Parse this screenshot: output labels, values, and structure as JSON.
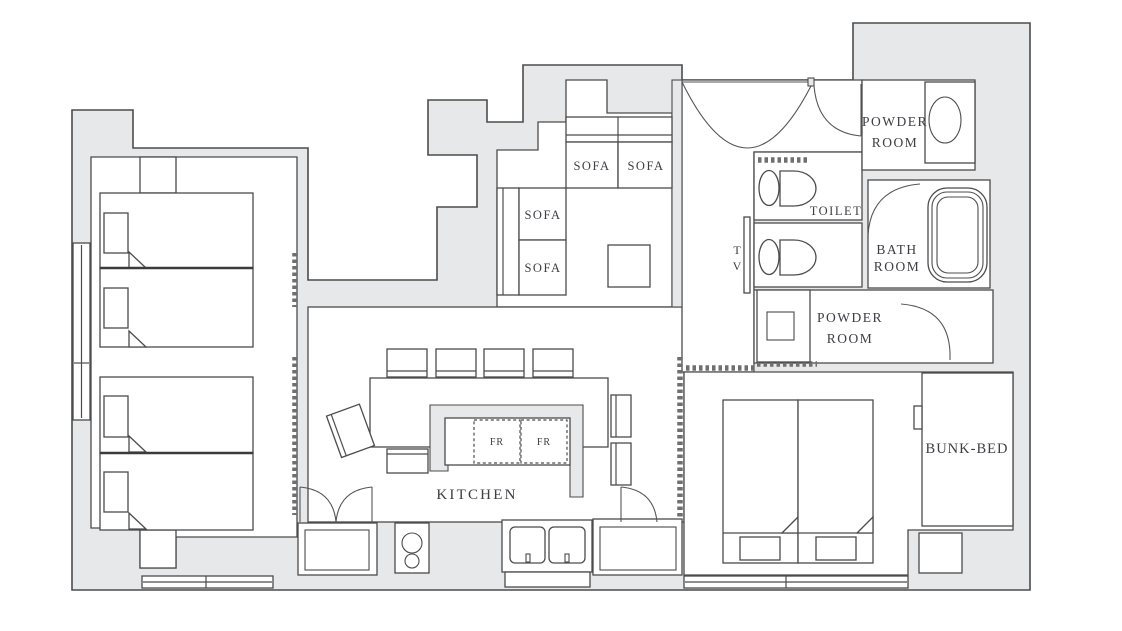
{
  "plan": {
    "type": "apartment-floor-plan",
    "labels": {
      "sofa": "SOFA",
      "kitchen": "KITCHEN",
      "fridge": "FR",
      "toilet": "TOILET",
      "tv": {
        "line1": "T",
        "line2": "V"
      },
      "powder_room_1": {
        "line1": "POWDER",
        "line2": "ROOM"
      },
      "powder_room_2": {
        "line1": "POWDER",
        "line2": "ROOM"
      },
      "bath_room": {
        "line1": "BATH",
        "line2": "ROOM"
      },
      "bunk_bed": "BUNK-BED"
    },
    "rooms_visible": [
      "SOFA area",
      "KITCHEN",
      "TOILET",
      "POWDER ROOM",
      "BATH ROOM",
      "POWDER ROOM",
      "BUNK-BED"
    ],
    "colors": {
      "background": "#ffffff",
      "wall_fill": "#e7e8e9",
      "line": "#4c4c4c",
      "text": "#3d3d43"
    }
  }
}
